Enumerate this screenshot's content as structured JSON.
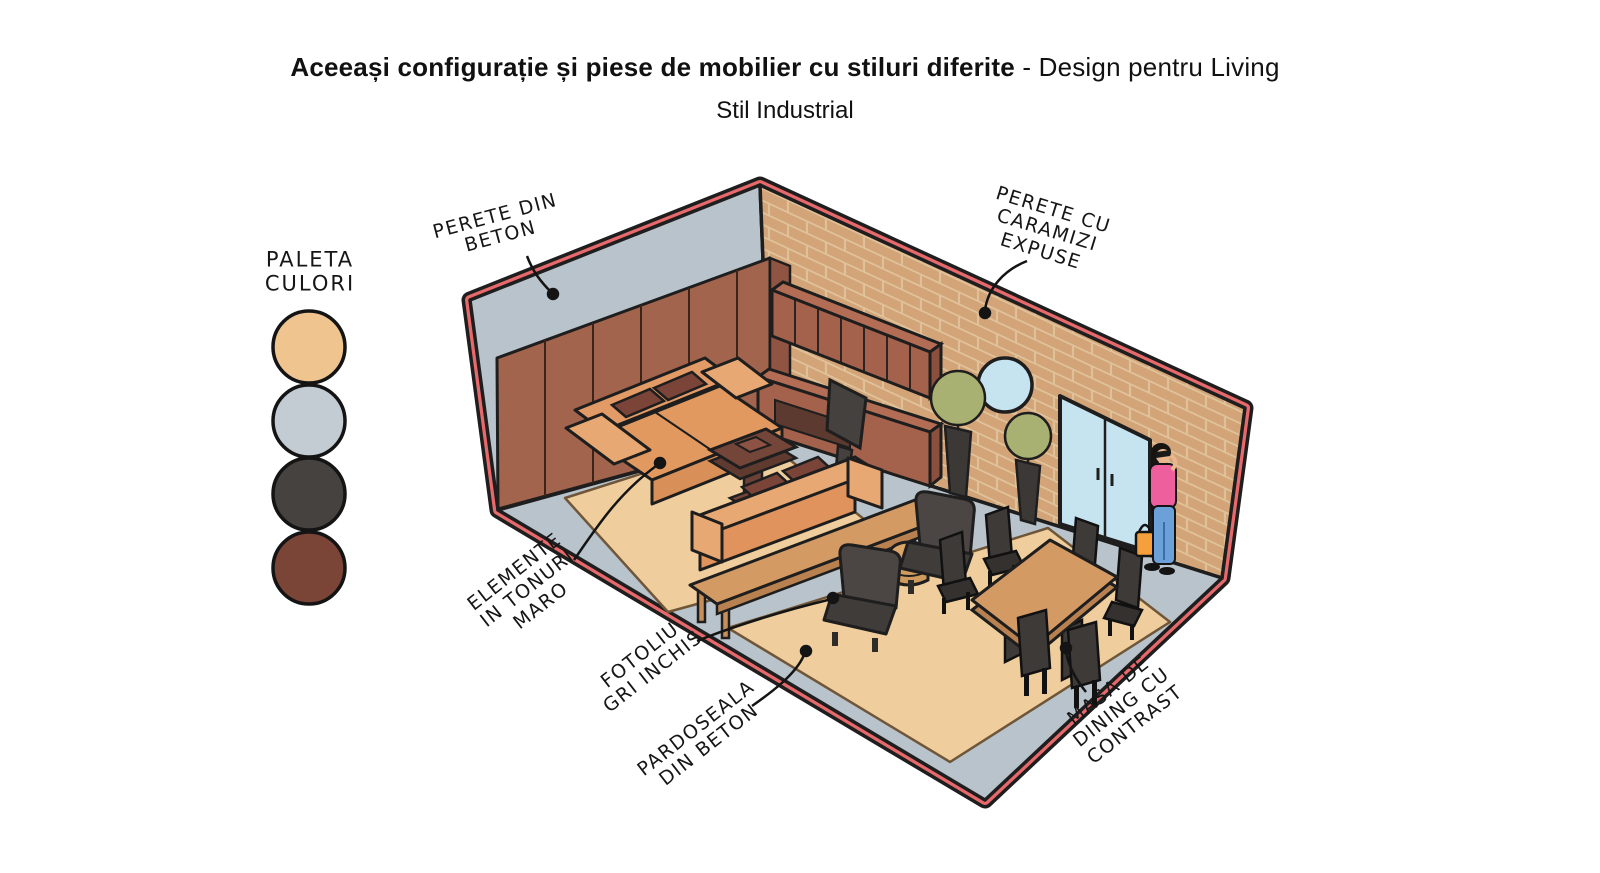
{
  "title": {
    "bold": "Aceeași configurație și piese de mobilier cu stiluri diferite",
    "rest": " - Design pentru Living",
    "subtitle": "Stil Industrial"
  },
  "palette": {
    "label": "PALETA\nCULORI",
    "colors": [
      {
        "name": "tan",
        "hex": "#f0c48f"
      },
      {
        "name": "blue-gray",
        "hex": "#c3ccd2"
      },
      {
        "name": "dark-gray",
        "hex": "#46423f"
      },
      {
        "name": "brown",
        "hex": "#7a4437"
      }
    ]
  },
  "annotations": {
    "concrete_wall": "PERETE DIN\nBETON",
    "brick_wall": "PERETE CU\nCARAMIZI\nEXPUSE",
    "brown_elements": "ELEMENTE\nIN TONURI\nMARO",
    "armchair": "FOTOLIU\nGRI INCHIS",
    "floor": "PARDOSEALA\nDIN BETON",
    "dining": "MASA DE\nDINING CU\nCONTRAST"
  },
  "scene": {
    "trim_color": "#e8696b",
    "concrete_color": "#b8c3cb",
    "brick_color": "#d2a478",
    "brick_mortar_color": "#e0c29a",
    "wood_panel_color": "#a3644e",
    "rug_color": "#f0cd9c",
    "sofa_color": "#e29a66",
    "cushion_color": "#7a4438",
    "dark_furniture_color": "#4b4643",
    "table_wood_color": "#d49a64",
    "glass_color": "#c6e3f0",
    "plant_color": "#a9b172"
  }
}
